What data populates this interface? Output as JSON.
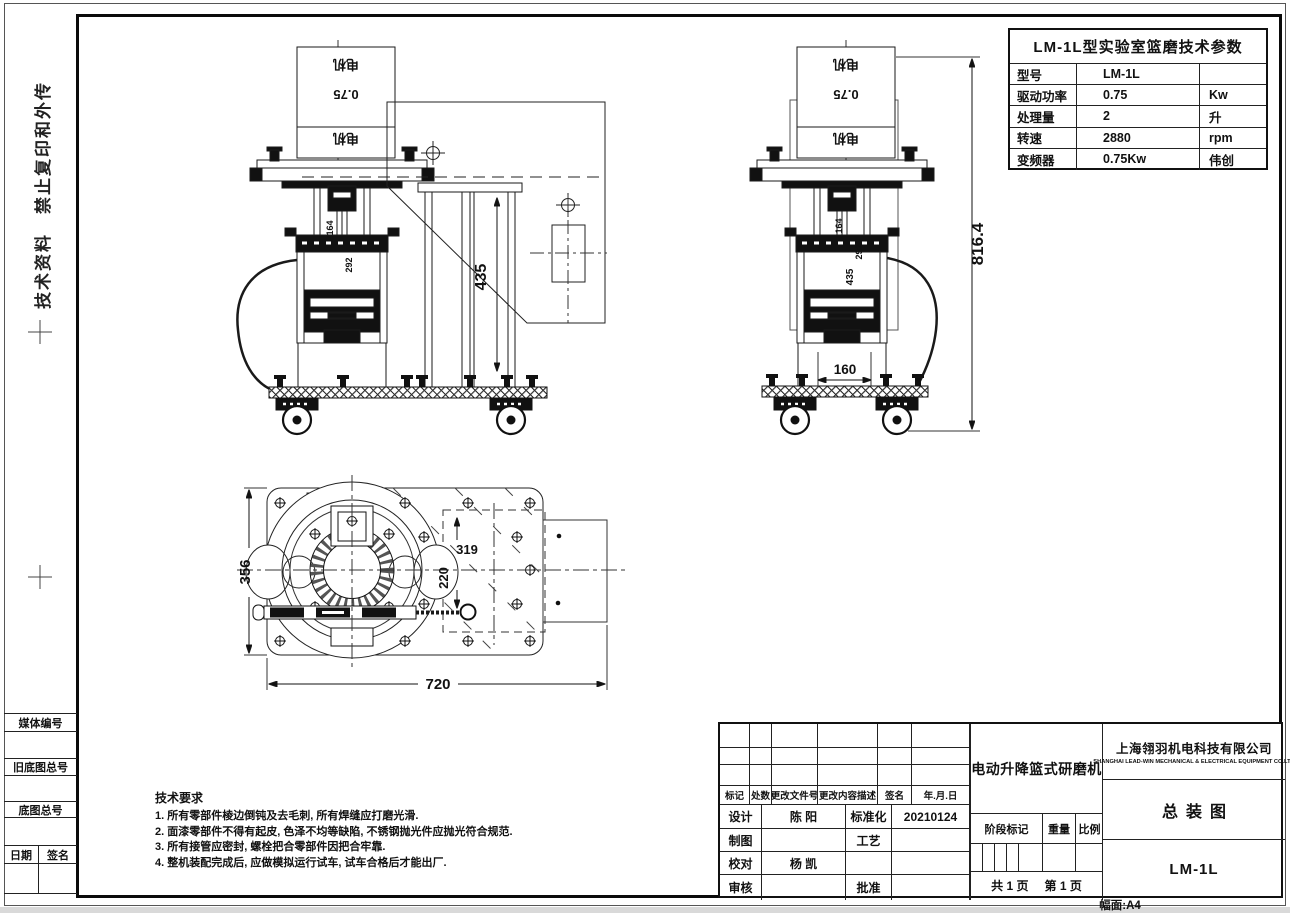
{
  "left_margin": {
    "notice": "技术资料　禁止复印和外传",
    "box_labels": [
      "媒体编号",
      "旧底图总号",
      "底图总号"
    ],
    "date_label": "日期",
    "sign_label": "签名"
  },
  "params_table": {
    "title": "LM-1L型实验室篮磨技术参数",
    "rows": [
      {
        "name": "型号",
        "value": "LM-1L",
        "unit": ""
      },
      {
        "name": "驱动功率",
        "value": "0.75",
        "unit": "Kw"
      },
      {
        "name": "处理量",
        "value": "2",
        "unit": "升"
      },
      {
        "name": "转速",
        "value": "2880",
        "unit": "rpm"
      },
      {
        "name": "变频器",
        "value": "0.75Kw",
        "unit": "伟创"
      }
    ]
  },
  "tech_requirements": {
    "title": "技术要求",
    "items": [
      "1. 所有零部件棱边倒钝及去毛刺, 所有焊缝应打磨光滑.",
      "2. 面漆零部件不得有起皮, 色泽不均等缺陷, 不锈钢抛光件应抛光符合规范.",
      "3. 所有接管应密封, 螺栓把合零部件因把合牢靠.",
      "4. 整机装配完成后, 应做模拟运行试车, 试车合格后才能出厂."
    ]
  },
  "title_block": {
    "revision_header": [
      "标记",
      "处数",
      "更改文件号",
      "更改内容描述",
      "签名",
      "年.月.日"
    ],
    "roles": [
      {
        "label": "设计",
        "name": "陈 阳",
        "label2": "标准化",
        "value2": "20210124"
      },
      {
        "label": "制图",
        "name": "",
        "label2": "工艺",
        "value2": ""
      },
      {
        "label": "校对",
        "name": "杨 凯",
        "label2": "",
        "value2": ""
      },
      {
        "label": "审核",
        "name": "",
        "label2": "批准",
        "value2": ""
      }
    ],
    "product_name": "电动升降篮式研磨机",
    "stage_label": "阶段标记",
    "weight_label": "重量",
    "scale_label": "比例",
    "pages_total": "共 1 页",
    "pages_current": "第 1 页",
    "company_cn": "上海翎羽机电科技有限公司",
    "company_en": "SHANGHAI LEAD-WIN MECHANICAL & ELECTRICAL EQUIPMENT CO.LTD",
    "drawing_title": "总装图",
    "drawing_no": "LM-1L",
    "sheet_format": "幅面:A4"
  },
  "drawing": {
    "labels": {
      "motor": "电机",
      "motor_power": "0.75",
      "dim_total_height": "816.4",
      "dim_column": "435",
      "dim_base": "160",
      "dim_shaft": "164",
      "dim_vessel": "292",
      "dim_plate_depth": "356",
      "dim_plate_width": "720",
      "dim_offset": "319",
      "dim_cutout": "220"
    }
  }
}
